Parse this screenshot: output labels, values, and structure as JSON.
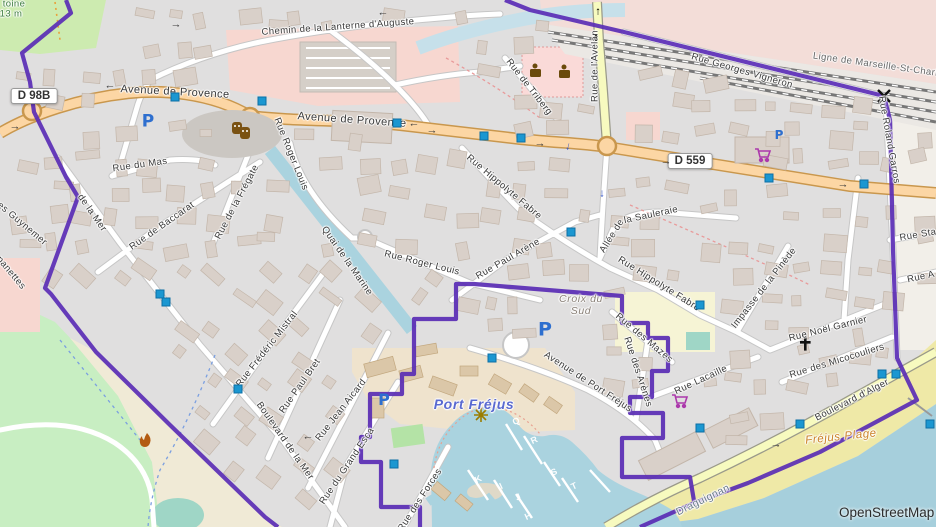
{
  "map": {
    "attribution": "OpenStreetMap",
    "road_shields": {
      "d98b": "D 98B",
      "d559": "D 559"
    },
    "railway_label": "Ligne de Marseille-St-Charles à",
    "place_labels": {
      "port_frejus": "Port Fréjus",
      "croix_du_sud": "Croix du Sud",
      "frejus_plage": "Fréjus Plage",
      "draguignan": "Draguignan",
      "hill_name_fragment": "toine",
      "elevation": "13 m"
    },
    "streets": {
      "chemin_lanterne": "Chemin de la Lanterne d'Auguste",
      "avenue_provence": "Avenue de Provence",
      "rue_triberg": "Rue de Triberg",
      "rue_avelan": "Rue de l'Avelan",
      "rue_georges_vigneron": "Rue Georges Vigneron",
      "rue_roland_garros": "Rue Roland Garros",
      "rue_sta": "Rue Sta",
      "rue_a": "Rue A",
      "rue_du_mas": "Rue du Mas",
      "rue_de_baccarat": "Rue de Baccarat",
      "rue_de_la_fregate": "Rue de la Frégate",
      "de_la_mer": "de la Mer",
      "guynemer": "ges Guynemer",
      "panettes": "panettes",
      "quai_marine": "Quai de la Marine",
      "rue_roger_louis": "Rue Roger Louis",
      "rue_hippolyte_fabre": "Rue Hippolyte Fabre",
      "rue_paul_arene": "Rue Paul Arène",
      "allee_de": "Allée de",
      "la_sauleraie": "la Sauleraie",
      "impasse_pinede": "Impasse de la Pinède",
      "rue_noel_garnier": "Rue Noël Garnier",
      "rue_micocouliers": "Rue des Micocouliers",
      "rue_lacaille": "Rue Lacaille",
      "bd_alger": "Boulevard d'Alger",
      "rue_frederic_mistral": "Rue Frédéric Mistral",
      "rue_paul_bret": "Rue Paul Bret",
      "rue_jean_aicard": "Rue Jean Aicard",
      "bd_mer": "Boulevard de la Mer",
      "rue_grand_esca": "Rue du Grand Esca",
      "rue_des_forces": "Rue des Forces",
      "av_port_frejus": "Avenue de Port Fréjus",
      "rue_des_mazes": "Rue des Mazes",
      "rue_des_arenes": "Rue des Arènes"
    },
    "pontoon_letters": [
      "Q",
      "R",
      "S",
      "T",
      "K",
      "I",
      "J",
      "H"
    ],
    "symbols": {
      "parking": "P",
      "arrow_left": "←",
      "arrow_right": "→",
      "arrow_up": "↑",
      "arrow_down": "↓"
    }
  }
}
